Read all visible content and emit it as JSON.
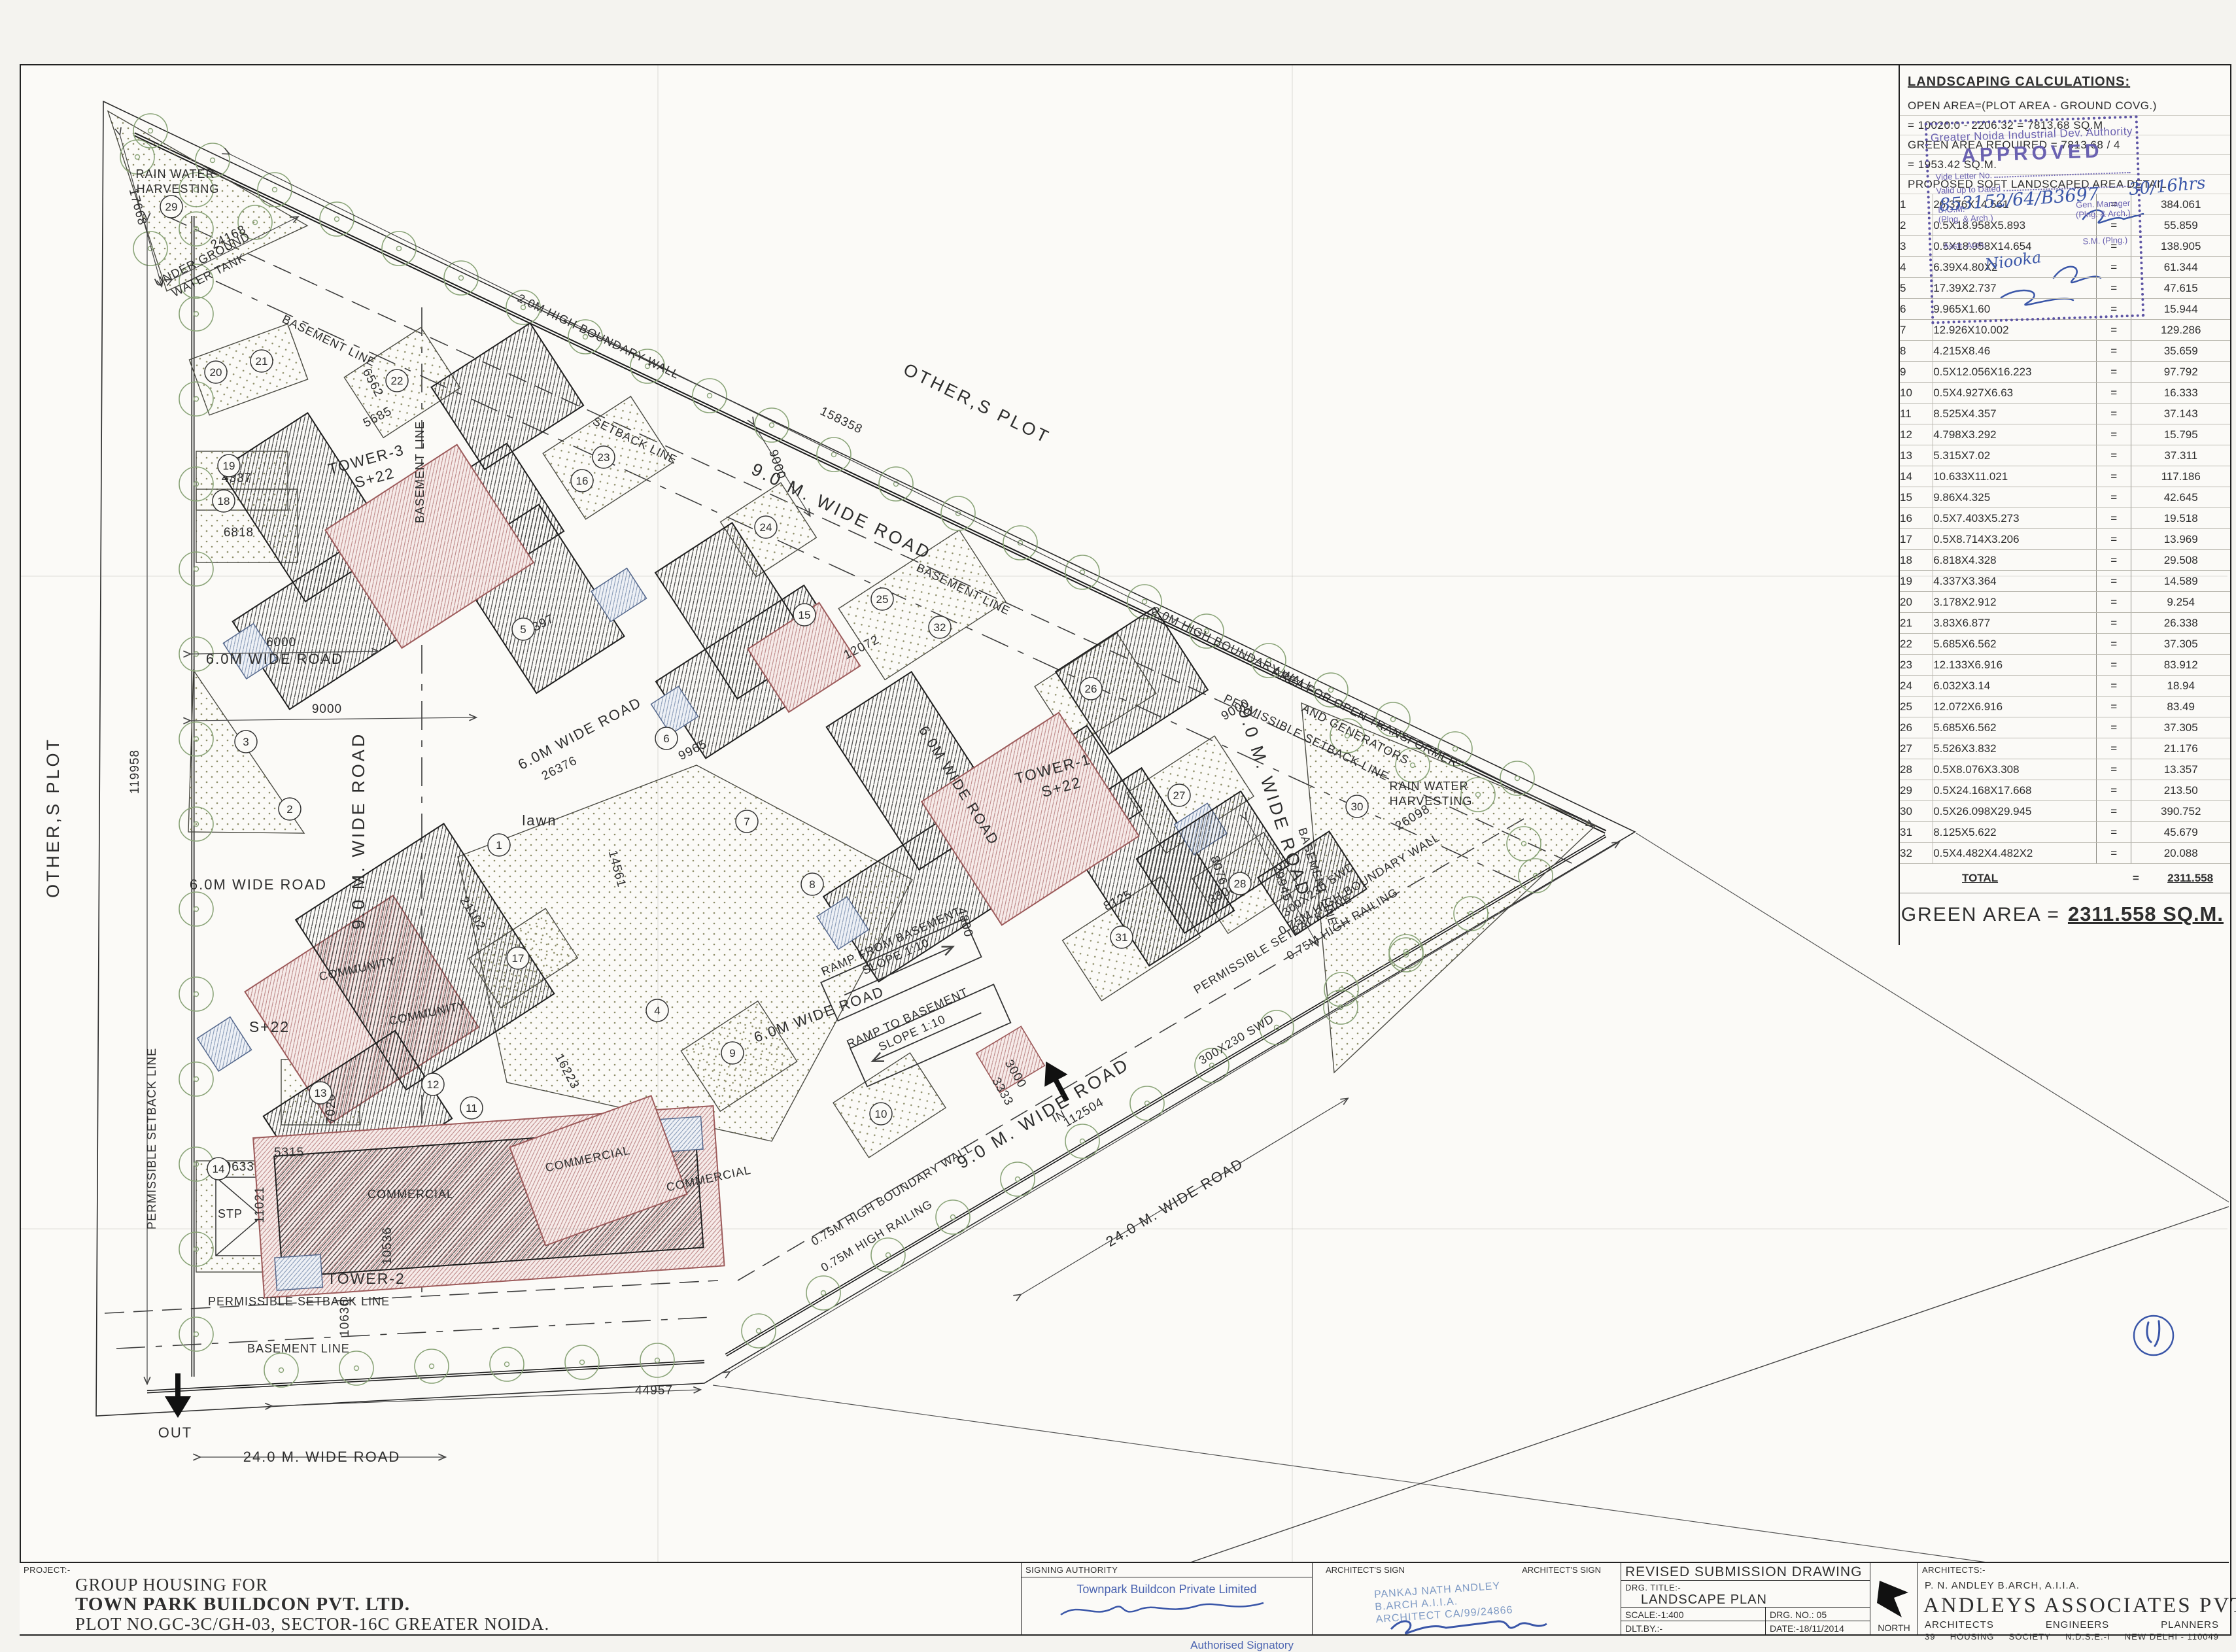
{
  "plan": {
    "labels": {
      "others_plot": "OTHER,S PLOT",
      "road9": "9.0 M. WIDE ROAD",
      "road6": "6.0M WIDE ROAD",
      "road24": "24.0 M. WIDE ROAD",
      "rain1": "RAIN WATER",
      "rain2": "HARVESTING",
      "ug1": "UNDER GROUND",
      "ug2": "WATER TANK",
      "tr1": "AREA FOR OPEN TRANSFORMER",
      "tr2": "AND GENERATORS",
      "basement": "BASEMENT LINE",
      "setback": "SETBACK LINE",
      "permissible": "PERMISSIBLE SETBACK LINE",
      "wall2m": "2.0M HIGH BOUNDARY WALL",
      "wall075": "0.75M HIGH BOUNDARY WALL",
      "rail075": "0.75M HIGH RAILING",
      "swd": "300X230 SWD",
      "tower1": "TOWER-1",
      "tower2": "TOWER-2",
      "tower3": "TOWER-3",
      "s22": "S+22",
      "community": "COMMUNITY",
      "commercial": "COMMERCIAL",
      "stp": "STP",
      "lawn": "lawn",
      "in_lbl": "IN",
      "out_lbl": "OUT",
      "ramp_from": "RAMP FROM BASEMENT",
      "ramp_to": "RAMP TO BASEMENT",
      "slope": "SLOPE 1:10",
      "sheet_no": "4"
    },
    "dims": {
      "d158358": "158358",
      "d119958": "119958",
      "d44957": "44957",
      "d112504": "112504",
      "d17668": "17668",
      "d24168": "24168",
      "d6000": "6000",
      "d9000": "9000",
      "d29945": "29945",
      "d26098": "26098",
      "d10536": "10536",
      "d10636": "10636",
      "d17397": "17397",
      "d26376": "26376",
      "d14561": "14561",
      "d9965": "9965",
      "d12072": "12072",
      "d16223": "16223",
      "d21102": "21102",
      "d8125": "8125",
      "d5315": "5315",
      "d7020": "7020",
      "d11021": "11021",
      "d10633": "10633",
      "d5685": "5685",
      "d6562": "6562",
      "d4337": "4337",
      "d6818": "6818",
      "d3000": "3000",
      "d3333": "3333",
      "d4800": "4800",
      "d8076": "8076",
      "d3308": "3308"
    },
    "badges": [
      "1",
      "2",
      "3",
      "4",
      "5",
      "6",
      "7",
      "8",
      "9",
      "10",
      "11",
      "12",
      "13",
      "14",
      "15",
      "16",
      "17",
      "18",
      "19",
      "20",
      "21",
      "22",
      "23",
      "24",
      "25",
      "26",
      "27",
      "28",
      "29",
      "30",
      "31",
      "32"
    ]
  },
  "calc": {
    "title": "LANDSCAPING CALCULATIONS:",
    "line1": "OPEN AREA=(PLOT AREA - GROUND COVG.)",
    "line2": "= 10020.0  - 2206.32 = 7813.68 SQ.M.",
    "line3": "GREEN AREA REQUIRED = 7813.68 / 4",
    "line4": "= 1953.42 SQ.M.",
    "line5": "PROPOSED SOFT LANDSCAPED AREA DETAIL",
    "equals": "=",
    "rows": [
      {
        "n": "1",
        "formula": "26.376X14.561",
        "value": "384.061"
      },
      {
        "n": "2",
        "formula": "0.5X18.958X5.893",
        "value": "55.859"
      },
      {
        "n": "3",
        "formula": "0.5X18.958X14.654",
        "value": "138.905"
      },
      {
        "n": "4",
        "formula": "6.39X4.80X2",
        "value": "61.344"
      },
      {
        "n": "5",
        "formula": "17.39X2.737",
        "value": "47.615"
      },
      {
        "n": "6",
        "formula": "9.965X1.60",
        "value": "15.944"
      },
      {
        "n": "7",
        "formula": "12.926X10.002",
        "value": "129.286"
      },
      {
        "n": "8",
        "formula": "4.215X8.46",
        "value": "35.659"
      },
      {
        "n": "9",
        "formula": "0.5X12.056X16.223",
        "value": "97.792"
      },
      {
        "n": "10",
        "formula": "0.5X4.927X6.63",
        "value": "16.333"
      },
      {
        "n": "11",
        "formula": "8.525X4.357",
        "value": "37.143"
      },
      {
        "n": "12",
        "formula": "4.798X3.292",
        "value": "15.795"
      },
      {
        "n": "13",
        "formula": "5.315X7.02",
        "value": "37.311"
      },
      {
        "n": "14",
        "formula": "10.633X11.021",
        "value": "117.186"
      },
      {
        "n": "15",
        "formula": "9.86X4.325",
        "value": "42.645"
      },
      {
        "n": "16",
        "formula": "0.5X7.403X5.273",
        "value": "19.518"
      },
      {
        "n": "17",
        "formula": "0.5X8.714X3.206",
        "value": "13.969"
      },
      {
        "n": "18",
        "formula": "6.818X4.328",
        "value": "29.508"
      },
      {
        "n": "19",
        "formula": "4.337X3.364",
        "value": "14.589"
      },
      {
        "n": "20",
        "formula": "3.178X2.912",
        "value": "9.254"
      },
      {
        "n": "21",
        "formula": "3.83X6.877",
        "value": "26.338"
      },
      {
        "n": "22",
        "formula": "5.685X6.562",
        "value": "37.305"
      },
      {
        "n": "23",
        "formula": "12.133X6.916",
        "value": "83.912"
      },
      {
        "n": "24",
        "formula": "6.032X3.14",
        "value": "18.94"
      },
      {
        "n": "25",
        "formula": "12.072X6.916",
        "value": "83.49"
      },
      {
        "n": "26",
        "formula": "5.685X6.562",
        "value": "37.305"
      },
      {
        "n": "27",
        "formula": "5.526X3.832",
        "value": "21.176"
      },
      {
        "n": "28",
        "formula": "0.5X8.076X3.308",
        "value": "13.357"
      },
      {
        "n": "29",
        "formula": "0.5X24.168X17.668",
        "value": "213.50"
      },
      {
        "n": "30",
        "formula": "0.5X26.098X29.945",
        "value": "390.752"
      },
      {
        "n": "31",
        "formula": "8.125X5.622",
        "value": "45.679"
      },
      {
        "n": "32",
        "formula": "0.5X4.482X4.482X2",
        "value": "20.088"
      }
    ],
    "total_label": "TOTAL",
    "total_value": "2311.558",
    "green_label": "GREEN AREA =",
    "green_value": "2311.558 SQ.M."
  },
  "stamp": {
    "authority": "Greater Noida Industrial Dev. Authority",
    "approved": "APPROVED",
    "vide": "Vide Letter No.",
    "valid": "Valid up to Dated",
    "dgm1": "D.G.M.",
    "dgm2": "(Plng. & Arch.)",
    "gm1": "Gen. Manager",
    "gm2": "(Plng. & Arch.)",
    "asst": "Asstt. Arch.",
    "sm": "S.M. (Plng.)",
    "hw_ref": "853152/64/B3697",
    "hw_date": "30/16hrs",
    "hw_name": "Niooka"
  },
  "titleblock": {
    "project_label": "PROJECT:-",
    "project_l1": "GROUP HOUSING FOR",
    "project_l2": "TOWN PARK BUILDCON PVT. LTD.",
    "project_l3": "PLOT NO.GC-3C/GH-03, SECTOR-16C GREATER NOIDA.",
    "signing_header": "SIGNING AUTHORITY",
    "signing_company": "Townpark Buildcon Private Limited",
    "signing_role": "Authorised Signatory",
    "arch_sign_header": "ARCHITECT'S SIGN",
    "arch_stamp_1": "PANKAJ NATH ANDLEY",
    "arch_stamp_2": "B.ARCH A.I.I.A.",
    "arch_stamp_3": "ARCHITECT CA/99/24866",
    "revised": "REVISED SUBMISSION  DRAWING",
    "drg_title_label": "DRG. TITLE:-",
    "drg_title": "LANDSCAPE PLAN",
    "scale": "SCALE:-1:400",
    "drg_no": "DRG. NO.: 05",
    "dlt": "DLT.BY.:-",
    "date": "DATE:-18/11/2014",
    "north": "NORTH",
    "architects_label": "ARCHITECTS:-",
    "architect_name": "P. N. ANDLEY    B.ARCH,  A.I.I.A.",
    "firm": "ANDLEYS  ASSOCIATES  PVT.  LTD.",
    "firm_row": [
      "ARCHITECTS",
      "ENGINEERS",
      "PLANNERS"
    ],
    "firm_addr": [
      "39",
      "HOUSING",
      "SOCIETY",
      "N.D.S.E.-I",
      "NEW DELHI - 110049"
    ]
  }
}
